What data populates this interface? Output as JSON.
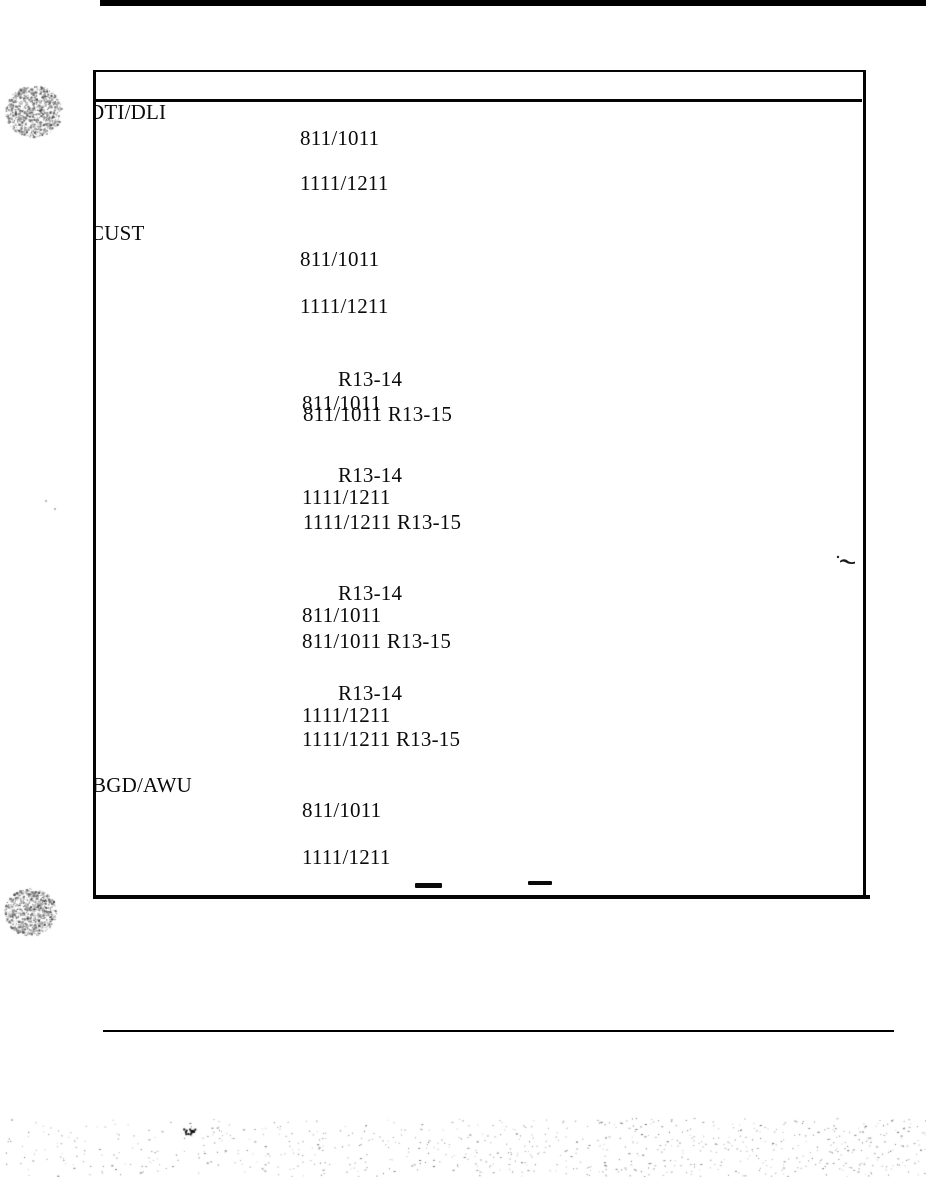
{
  "page": {
    "kind": "scanned document page",
    "paper_color": "#ffffff",
    "ink_color": "#0b0b0b"
  },
  "table": {
    "header_text": "",
    "row_labels": [
      "DTI/DLI",
      "CUST",
      "BGD/AWU"
    ],
    "items": [
      {
        "text": "DTI/DLI",
        "x": 94,
        "y": 102,
        "clip": 5,
        "role": "row-label"
      },
      {
        "text": "811/1011",
        "x": 300,
        "y": 128,
        "clip": 0,
        "role": "value"
      },
      {
        "text": "1111/1211",
        "x": 300,
        "y": 173,
        "clip": 0,
        "role": "value"
      },
      {
        "text": "CUST",
        "x": 94,
        "y": 223,
        "clip": 4,
        "role": "row-label"
      },
      {
        "text": "811/1011",
        "x": 300,
        "y": 249,
        "clip": 0,
        "role": "value"
      },
      {
        "text": "1111/1211",
        "x": 300,
        "y": 296,
        "clip": 0,
        "role": "value"
      },
      {
        "text": "R13-14",
        "x": 338,
        "y": 369,
        "clip": 0,
        "role": "value"
      },
      {
        "text": "811/1011",
        "x": 302,
        "y": 393,
        "clip": 0,
        "role": "value"
      },
      {
        "text": "811/1011 R13-15",
        "x": 303,
        "y": 404,
        "clip": 0,
        "role": "value"
      },
      {
        "text": "R13-14",
        "x": 338,
        "y": 465,
        "clip": 0,
        "role": "value"
      },
      {
        "text": "1111/1211",
        "x": 302,
        "y": 487,
        "clip": 0,
        "role": "value"
      },
      {
        "text": "1111/1211 R13-15",
        "x": 303,
        "y": 512,
        "clip": 0,
        "role": "value"
      },
      {
        "text": "R13-14",
        "x": 338,
        "y": 583,
        "clip": 0,
        "role": "value"
      },
      {
        "text": "811/1011",
        "x": 302,
        "y": 605,
        "clip": 0,
        "role": "value"
      },
      {
        "text": "811/1011 R13-15",
        "x": 302,
        "y": 631,
        "clip": 0,
        "role": "value"
      },
      {
        "text": "R13-14",
        "x": 338,
        "y": 683,
        "clip": 0,
        "role": "value"
      },
      {
        "text": "1111/1211",
        "x": 302,
        "y": 705,
        "clip": 0,
        "role": "value"
      },
      {
        "text": "1111/1211 R13-15",
        "x": 302,
        "y": 729,
        "clip": 0,
        "role": "value"
      },
      {
        "text": "BGD/AWU",
        "x": 94,
        "y": 775,
        "clip": 2,
        "role": "row-label"
      },
      {
        "text": "811/1011",
        "x": 302,
        "y": 800,
        "clip": 0,
        "role": "value"
      },
      {
        "text": "1111/1211",
        "x": 302,
        "y": 847,
        "clip": 0,
        "role": "value"
      }
    ]
  },
  "marks": {
    "dash_count": 2,
    "hole_punch_count": 2
  }
}
